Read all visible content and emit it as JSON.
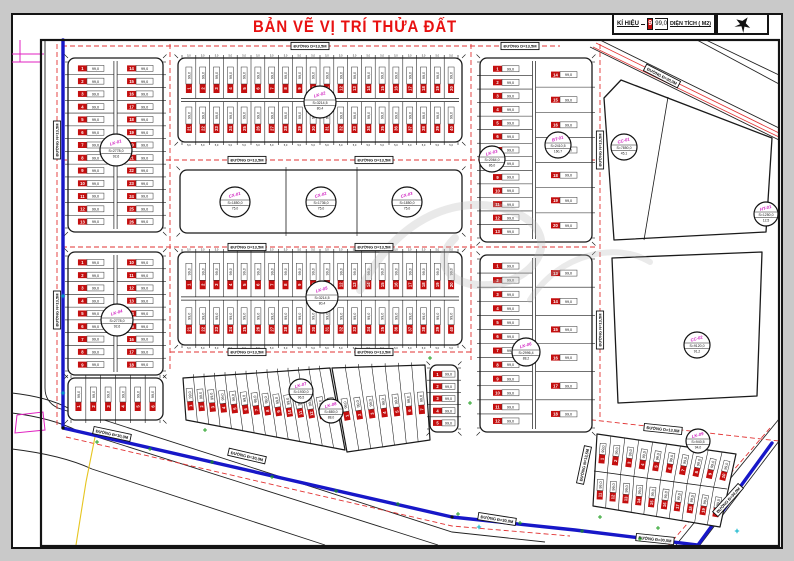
{
  "title": "BẢN VẼ VỊ TRÍ THỬA ĐẤT",
  "legend": {
    "symbol_label": "KÍ HIỆU",
    "sample_id": "9",
    "sample_area": "99,0",
    "area_label": "DIỆN TÍCH ( M2)"
  },
  "colors": {
    "plot_id_bg": "#c40f0f",
    "road_dash": "#e23333",
    "boundary_blue": "#1717c8",
    "marker_code": "#d020c0",
    "green_mark": "#179a17",
    "cyan_mark": "#00b0c8",
    "magenta": "#e020c0",
    "yellow": "#e6c520",
    "ink": "#1a1a1a",
    "title_red": "#e81111"
  },
  "map": {
    "frame": {
      "x": 41,
      "y": 40,
      "w": 738,
      "h": 506
    },
    "plot_area_label": "99,0",
    "dim_label": "5,0",
    "road_label_h": "ĐƯỜNG D=13,5M",
    "road_label_v": "ĐƯỜNG N=13,5M",
    "road_label_d": "ĐƯỜNG Đ=30,0M",
    "blocks": [
      {
        "type": "rows",
        "name": "block-a",
        "x": 68,
        "y": 58,
        "w": 95,
        "h": 174,
        "rows": 13
      },
      {
        "type": "strips",
        "name": "block-b",
        "x": 178,
        "y": 58,
        "w": 284,
        "h": 84,
        "n": 20,
        "dims": true
      },
      {
        "type": "big",
        "name": "block-c",
        "x": 180,
        "y": 170,
        "w": 282,
        "h": 63,
        "dividers": [
          286,
          357
        ]
      },
      {
        "type": "mixed",
        "name": "block-d",
        "x": 480,
        "y": 58,
        "w": 112,
        "h": 184,
        "sx": 534,
        "left_rows": 13,
        "right_rows": 7
      },
      {
        "type": "rows",
        "name": "block-g1",
        "x": 68,
        "y": 252,
        "w": 95,
        "h": 123,
        "rows": 9
      },
      {
        "type": "strips1",
        "name": "block-g2",
        "x": 68,
        "y": 378,
        "w": 95,
        "h": 42,
        "n": 6
      },
      {
        "type": "strips",
        "name": "block-h",
        "x": 178,
        "y": 252,
        "w": 284,
        "h": 93,
        "n": 20,
        "dims": true
      },
      {
        "type": "mixed",
        "name": "block-i",
        "x": 480,
        "y": 255,
        "w": 112,
        "h": 177,
        "sx": 534,
        "left_rows": 12,
        "right_rows": 6
      },
      {
        "type": "diag",
        "name": "block-j1",
        "pts": [
          [
            183,
            378
          ],
          [
            330,
            368
          ],
          [
            345,
            450
          ],
          [
            186,
            420
          ]
        ],
        "n": 14
      },
      {
        "type": "diag",
        "name": "block-j2",
        "pts": [
          [
            332,
            368
          ],
          [
            425,
            365
          ],
          [
            430,
            440
          ],
          [
            347,
            452
          ]
        ],
        "n": 7
      },
      {
        "type": "rows1",
        "name": "block-j3",
        "x": 430,
        "y": 365,
        "w": 28,
        "h": 67,
        "rows": 5
      },
      {
        "type": "diag2",
        "name": "block-k",
        "top": [
          [
            597,
            434
          ],
          [
            736,
            454
          ]
        ],
        "mid": [
          [
            594,
            471
          ],
          [
            727,
            489
          ]
        ],
        "bot": [
          [
            593,
            506
          ],
          [
            720,
            527
          ]
        ],
        "n": 10
      },
      {
        "type": "poly",
        "name": "block-e",
        "pts": [
          [
            604,
            98
          ],
          [
            621,
            80
          ],
          [
            772,
            138
          ],
          [
            766,
            232
          ],
          [
            614,
            240
          ]
        ],
        "divider": [
          [
            668,
            97
          ],
          [
            644,
            240
          ]
        ]
      },
      {
        "type": "poly",
        "name": "block-f",
        "pts": [
          [
            612,
            258
          ],
          [
            762,
            252
          ],
          [
            757,
            396
          ],
          [
            618,
            403
          ]
        ]
      }
    ],
    "markers": [
      {
        "code": "LK-01",
        "x": 116,
        "y": 150,
        "r": 16,
        "s": "S=2778,0",
        "n": "92,6"
      },
      {
        "code": "LK-02",
        "x": 320,
        "y": 102,
        "r": 16,
        "s": "S=3214,5",
        "n": "80,4"
      },
      {
        "code": "CX-01",
        "x": 235,
        "y": 202,
        "r": 15,
        "s": "S=1850,0",
        "n": "75,0"
      },
      {
        "code": "CX-02",
        "x": 321,
        "y": 202,
        "r": 15,
        "s": "S=1736,0",
        "n": "75,0"
      },
      {
        "code": "CX-03",
        "x": 407,
        "y": 202,
        "r": 15,
        "s": "S=1850,0",
        "n": "75,0"
      },
      {
        "code": "LK-03",
        "x": 492,
        "y": 159,
        "r": 13,
        "s": "S=2064,0",
        "n": "86,0"
      },
      {
        "code": "BT-01",
        "x": 558,
        "y": 145,
        "r": 13,
        "s": "S=2410,5",
        "n": "160,7"
      },
      {
        "code": "CC-01",
        "x": 624,
        "y": 147,
        "r": 13,
        "s": "S=7850,0",
        "n": "45,1"
      },
      {
        "code": "HT-01",
        "x": 766,
        "y": 214,
        "r": 12,
        "s": "S=1250,0",
        "n": "12,5"
      },
      {
        "code": "CC-02",
        "x": 697,
        "y": 345,
        "r": 13,
        "s": "S=9120,0",
        "n": "91,2"
      },
      {
        "code": "LK-04",
        "x": 117,
        "y": 320,
        "r": 16,
        "s": "S=2778,0",
        "n": "92,6"
      },
      {
        "code": "LK-05",
        "x": 322,
        "y": 297,
        "r": 16,
        "s": "S=3214,5",
        "n": "80,4"
      },
      {
        "code": "LK-06",
        "x": 526,
        "y": 352,
        "r": 14,
        "s": "S=2996,4",
        "n": "88,2"
      },
      {
        "code": "LK-07",
        "x": 301,
        "y": 391,
        "r": 12,
        "s": "S=1930,0",
        "n": "96,5"
      },
      {
        "code": "LK-08",
        "x": 331,
        "y": 411,
        "r": 12,
        "s": "S=880,0",
        "n": "88,0"
      },
      {
        "code": "LK-09",
        "x": 698,
        "y": 441,
        "r": 12,
        "s": "S=940,5",
        "n": "94,0"
      }
    ],
    "road_labels": [
      {
        "x": 310,
        "y": 46,
        "rot": 0,
        "k": "h"
      },
      {
        "x": 520,
        "y": 46,
        "rot": 0,
        "k": "h"
      },
      {
        "x": 247,
        "y": 160,
        "rot": 0,
        "k": "h"
      },
      {
        "x": 374,
        "y": 160,
        "rot": 0,
        "k": "h"
      },
      {
        "x": 247,
        "y": 247,
        "rot": 0,
        "k": "h"
      },
      {
        "x": 374,
        "y": 247,
        "rot": 0,
        "k": "h"
      },
      {
        "x": 247,
        "y": 352,
        "rot": 0,
        "k": "h"
      },
      {
        "x": 374,
        "y": 352,
        "rot": 0,
        "k": "h"
      },
      {
        "x": 57,
        "y": 140,
        "rot": -90,
        "k": "v"
      },
      {
        "x": 57,
        "y": 310,
        "rot": -90,
        "k": "v"
      },
      {
        "x": 600,
        "y": 150,
        "rot": -90,
        "k": "v"
      },
      {
        "x": 600,
        "y": 330,
        "rot": -90,
        "k": "v"
      },
      {
        "x": 584,
        "y": 465,
        "rot": -78,
        "k": "v"
      },
      {
        "x": 662,
        "y": 76,
        "rot": 27,
        "k": "d"
      },
      {
        "x": 247,
        "y": 456,
        "rot": 13,
        "k": "d"
      },
      {
        "x": 497,
        "y": 519,
        "rot": 9,
        "k": "d"
      },
      {
        "x": 655,
        "y": 539,
        "rot": 6,
        "k": "d"
      },
      {
        "x": 663,
        "y": 429,
        "rot": 6,
        "k": "h"
      },
      {
        "x": 728,
        "y": 500,
        "rot": -48,
        "k": "d"
      },
      {
        "x": 112,
        "y": 434,
        "rot": 12,
        "k": "d"
      }
    ],
    "red_dashed": [
      [
        62,
        46,
        560,
        46
      ],
      [
        62,
        160,
        597,
        160
      ],
      [
        62,
        247,
        597,
        247
      ],
      [
        170,
        352,
        472,
        352
      ],
      [
        57,
        44,
        57,
        428
      ],
      [
        170,
        44,
        170,
        370
      ],
      [
        471,
        44,
        471,
        360
      ],
      [
        600,
        44,
        600,
        420
      ],
      [
        575,
        418,
        779,
        441
      ],
      [
        770,
        428,
        668,
        546
      ]
    ],
    "red_dashed_polylines": [
      [
        [
          66,
          437
        ],
        [
          452,
          526
        ],
        [
          570,
          536
        ]
      ]
    ],
    "red_solid": [
      [
        596,
        43,
        779,
        133
      ],
      [
        593,
        47,
        779,
        137
      ]
    ],
    "blue": [
      [
        [
          63,
          40
        ],
        [
          63,
          428
        ],
        [
          452,
          517
        ],
        [
          575,
          530
        ],
        [
          698,
          545
        ]
      ],
      [
        [
          698,
          545
        ],
        [
          772,
          443
        ]
      ]
    ],
    "black_paths": [
      "M 45,40 L 45,388 Q 45,402 58,408 L 95,420",
      "M 12,393 Q 48,397 70,409 L 452,532 L 545,542",
      "M 12,413 Q 52,418 78,431 L 438,545",
      "M 12,449 Q 62,455 92,469 L 325,545",
      "M 600,40 L 779,128",
      "M 590,47 L 779,140",
      "M 706,40 L 779,75",
      "M 697,40 L 779,84",
      "M 779,419 L 676,545",
      "M 779,441 L 700,545"
    ],
    "magenta_lines": [
      [
        [
          12,
          54
        ],
        [
          44,
          54
        ]
      ],
      [
        [
          12,
          62
        ],
        [
          40,
          62
        ]
      ],
      [
        [
          20,
          40
        ],
        [
          20,
          62
        ]
      ],
      [
        [
          17,
          415
        ],
        [
          43,
          412
        ],
        [
          45,
          430
        ],
        [
          15,
          433
        ],
        [
          17,
          415
        ]
      ]
    ],
    "yellow_lines": [
      [
        [
          95,
          437
        ],
        [
          86,
          482
        ],
        [
          76,
          545
        ]
      ]
    ],
    "green_marks": [
      [
        150,
        449
      ],
      [
        212,
        462
      ],
      [
        272,
        477
      ],
      [
        336,
        491
      ],
      [
        398,
        504
      ],
      [
        458,
        514
      ],
      [
        520,
        523
      ],
      [
        582,
        531
      ],
      [
        640,
        539
      ],
      [
        97,
        442
      ],
      [
        205,
        430
      ],
      [
        430,
        358
      ],
      [
        470,
        403
      ],
      [
        600,
        517
      ],
      [
        658,
        528
      ]
    ],
    "cyan_marks": [
      [
        63,
        296
      ],
      [
        63,
        393
      ],
      [
        737,
        531
      ],
      [
        479,
        527
      ]
    ],
    "dots": [
      [
        63,
        428
      ],
      [
        452,
        517
      ]
    ]
  }
}
